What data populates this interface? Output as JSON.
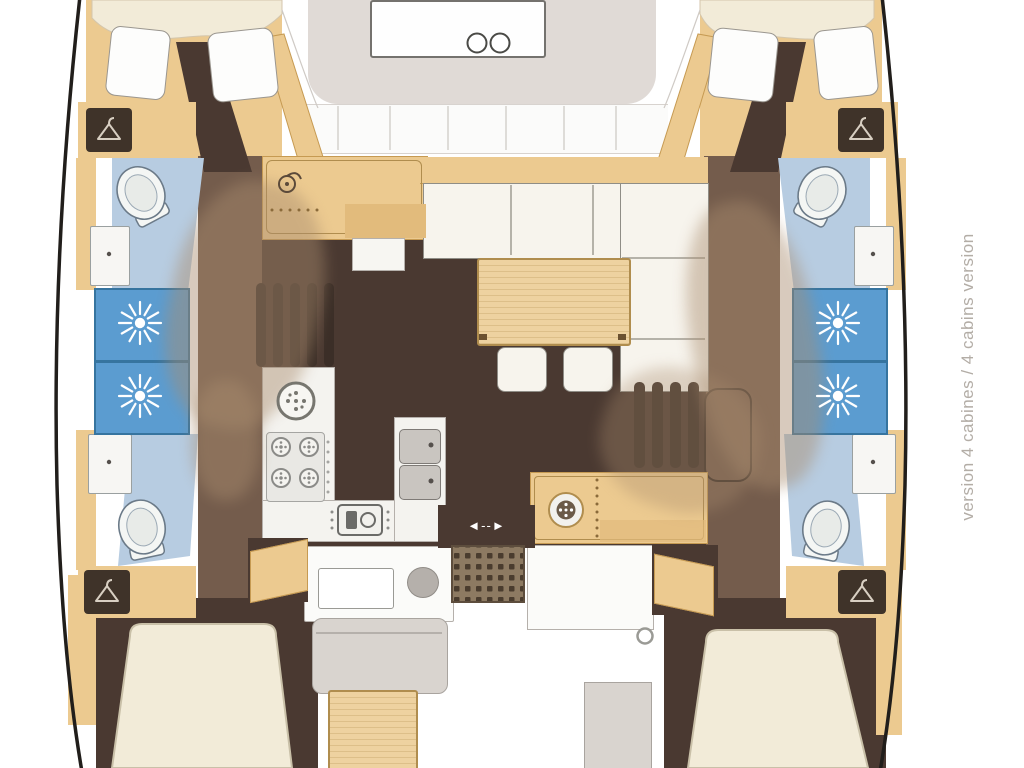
{
  "side_label": "version 4 cabines / 4 cabins version",
  "door_arrow": "◄--►",
  "colors": {
    "hull_line": "#211e1b",
    "wood": "#ecca90",
    "wood_dark": "#c69a52",
    "wood_deep": "#e2bb7c",
    "table_wood": "#eed2a0",
    "floor_dark": "#4a3931",
    "corridor": "#745c4c",
    "overlay_tan": "#a98c6e",
    "bath_blue": "#b7cce1",
    "shower_blue": "#5b9cd0",
    "shower_border": "#36749f",
    "cream": "#f2ebd8",
    "sofa_white": "#f7f4ed",
    "counter_white": "#f4f3ef",
    "deck_gray": "#e0dad6",
    "cockpit_gray": "#d9d4cf",
    "grating_base": "#8d7a62",
    "grating_dot": "#4a3c2e",
    "steps_dark": "#3b2e27",
    "outline_gray": "#8f8d86",
    "label_gray": "#b3ada6"
  },
  "icons": {
    "wardrobe": "hanger-icon",
    "shower": "shower-jets-icon",
    "toilet": "toilet-icon",
    "burner": "gas-burner-icon",
    "oven": "oven-icon",
    "round_sink": "round-sink-icon",
    "bath_sink": "sink-icon",
    "door": "sliding-door-arrow-icon",
    "hatch": "deck-hatch-icon"
  },
  "rooms": {
    "port_hull": [
      "forward cabin",
      "forward bathroom",
      "shower",
      "aft bathroom",
      "aft cabin"
    ],
    "starboard_hull": [
      "forward cabin",
      "forward bathroom",
      "shower",
      "aft bathroom",
      "aft cabin"
    ],
    "center": [
      "foredeck",
      "salon",
      "galley",
      "cockpit"
    ]
  }
}
